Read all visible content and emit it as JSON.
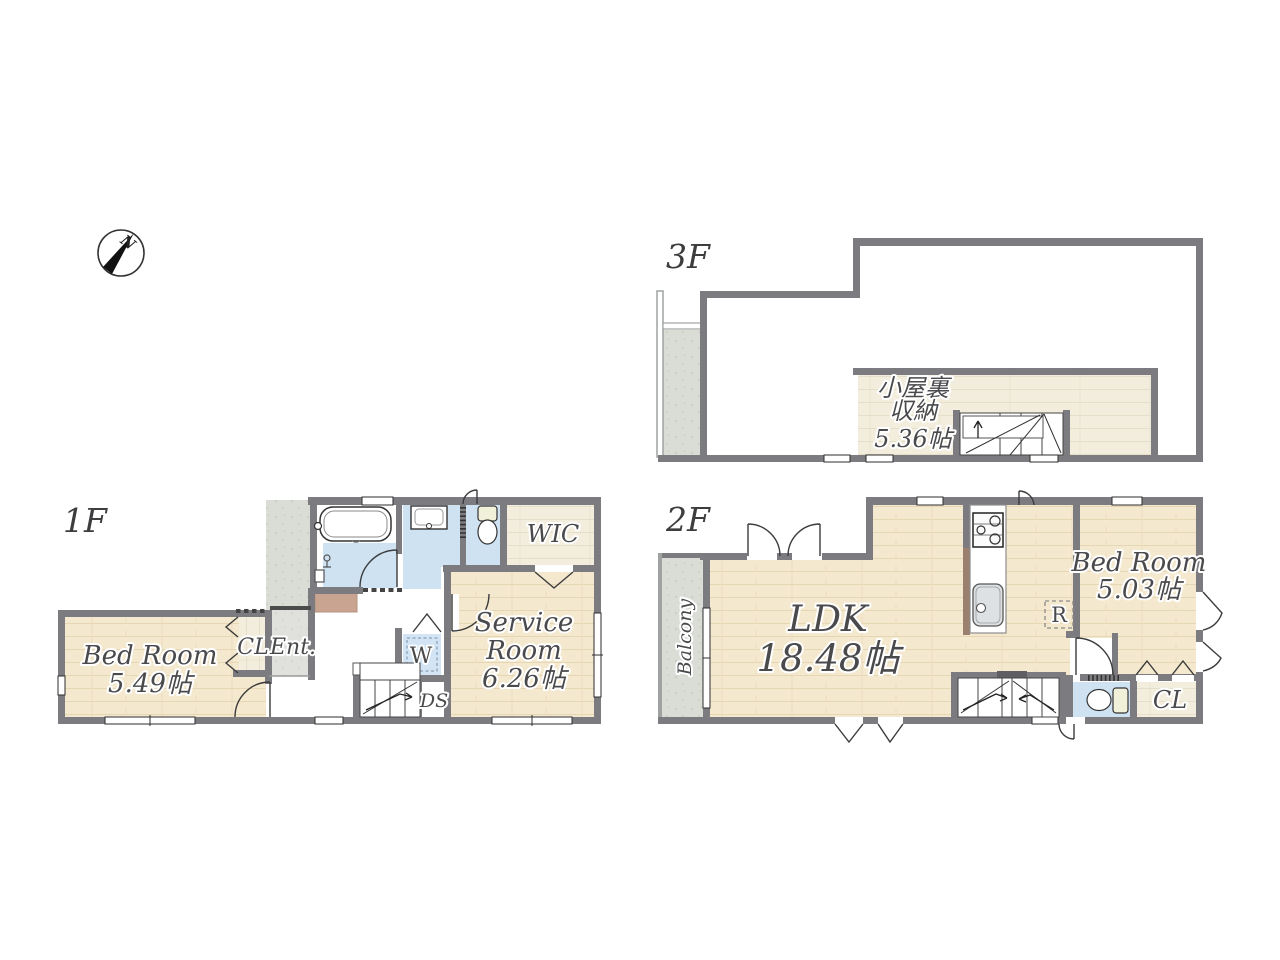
{
  "compass": {
    "north": "N"
  },
  "floor_1f": {
    "label": "1F",
    "bedroom_name": "Bed Room",
    "bedroom_size": "5.49帖",
    "closet": "CL",
    "entrance": "Ent.",
    "wic": "WIC",
    "service_line1": "Service",
    "service_line2": "Room",
    "service_size": "6.26帖",
    "washer": "W",
    "duct_space": "DS"
  },
  "floor_2f": {
    "label": "2F",
    "ldk_name": "LDK",
    "ldk_size": "18.48帖",
    "balcony": "Balcony",
    "bedroom_name": "Bed Room",
    "bedroom_size": "5.03帖",
    "refrigerator": "R",
    "closet": "CL"
  },
  "floor_3f": {
    "label": "3F",
    "attic_line1": "小屋裏",
    "attic_line2": "収納",
    "attic_size": "5.36帖"
  },
  "colors": {
    "wall": "#7c7c80",
    "wood_floor": "#f4e9cf",
    "wood_light": "#f2ecdb",
    "water_blue": "#cfe2f2",
    "stone_gray": "#dadcd6",
    "tan_mat": "#c9a491",
    "counter_brown": "#9b8070",
    "label_text": "#4a4a4c"
  }
}
